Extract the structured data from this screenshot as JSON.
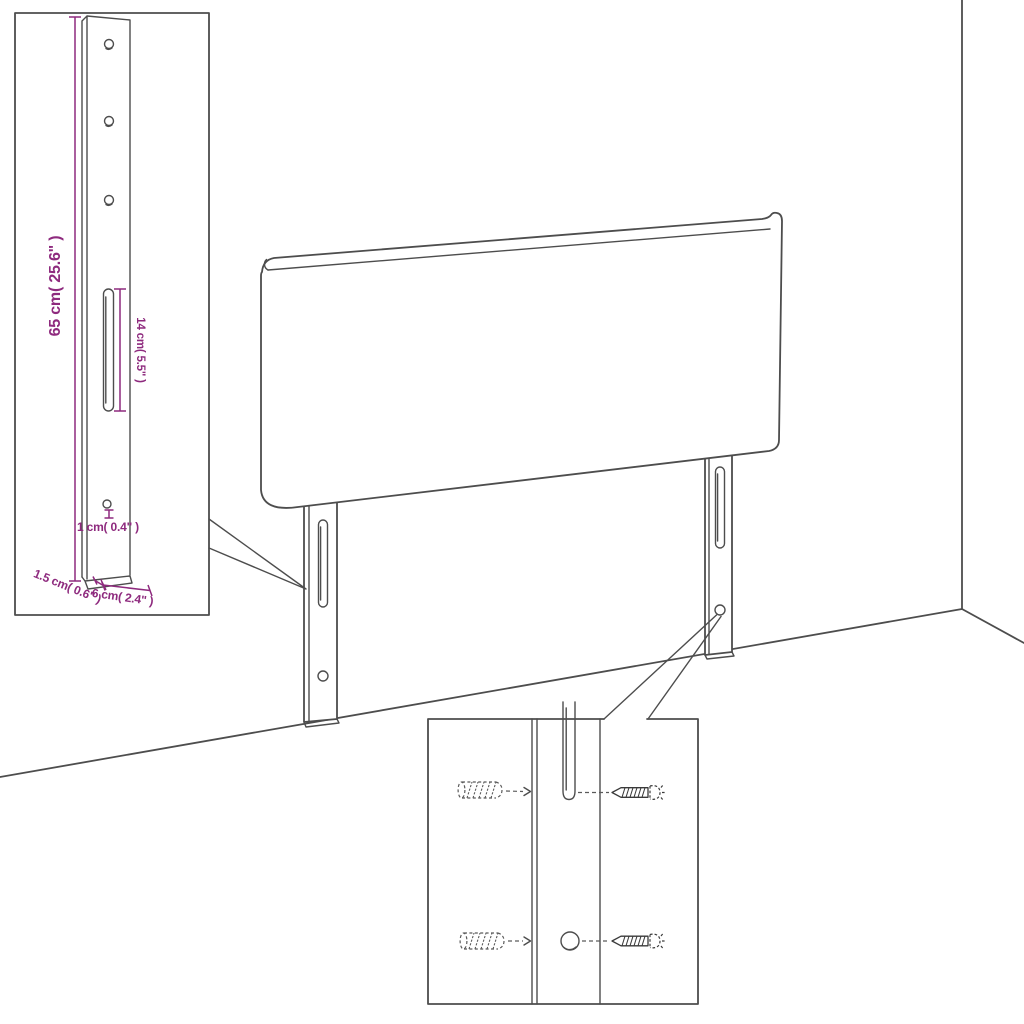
{
  "page": {
    "background": "#ffffff"
  },
  "colors": {
    "background": "#ffffff",
    "outline": "#4d4d4d",
    "dimension": "#8e2a7e",
    "hardware": "#3a3a3a"
  },
  "dims": {
    "d65": "65 cm( 25.6\" )",
    "d14": "14 cm( 5.5\" )",
    "d1": "1 cm( 0.4\" )",
    "d15": "1.5 cm( 0.6\" )",
    "d6": "6 cm( 2.4\" )"
  }
}
